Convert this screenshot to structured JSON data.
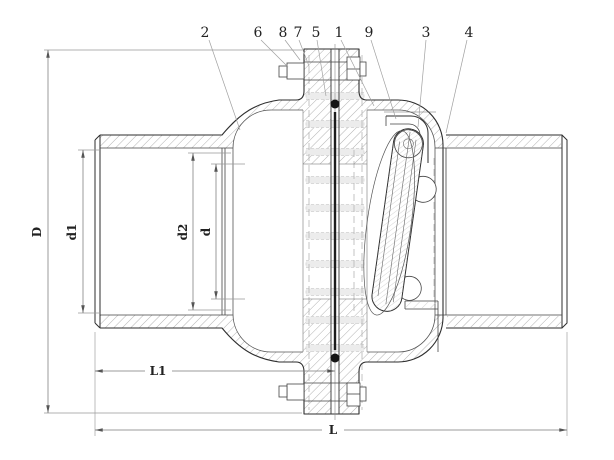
{
  "diagram": {
    "background_color": "#ffffff",
    "line_color": "#2e2e2e",
    "hatch_color": "#a9a9a9",
    "dimension_color": "#7a7a7a",
    "part_labels": [
      "2",
      "6",
      "8",
      "7",
      "5",
      "1",
      "9",
      "3",
      "4"
    ],
    "dimension_labels": [
      "D",
      "d1",
      "d2",
      "d",
      "L1",
      "L"
    ]
  }
}
